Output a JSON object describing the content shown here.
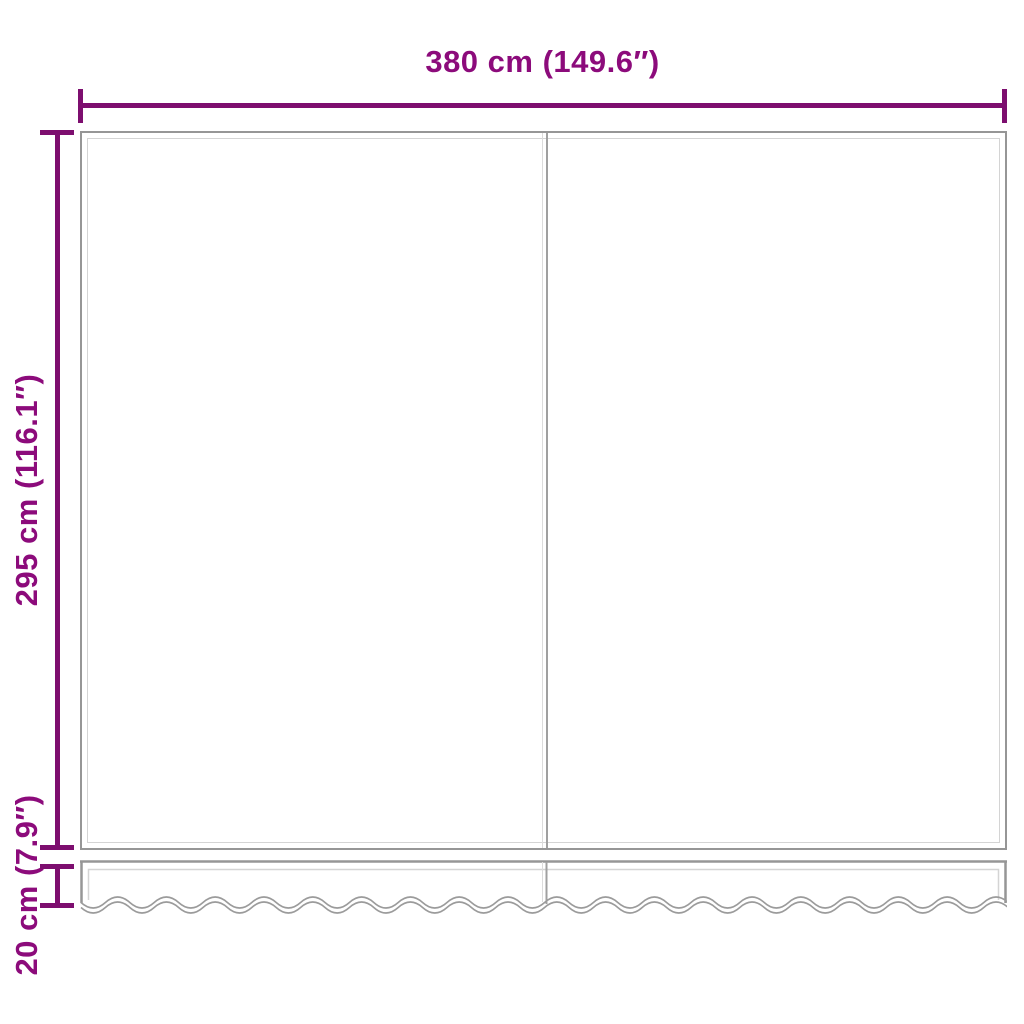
{
  "diagram": {
    "title": "Replacement awning fabric with wavy valance — dimension diagram",
    "colors": {
      "dimension_text": "#8c0b7b",
      "dimension_line": "#7d0e6f",
      "fabric_outline": "#969696",
      "hem_line": "#d4d4d4",
      "background": "#ffffff"
    },
    "dimensions": {
      "width": {
        "label": "380 cm (149.6″)",
        "cm": 380,
        "inches": 149.6
      },
      "height": {
        "label": "295 cm (116.1″)",
        "cm": 295,
        "inches": 116.1
      },
      "valance": {
        "label": "20 cm (7.9″)",
        "cm": 20,
        "inches": 7.9
      }
    }
  }
}
